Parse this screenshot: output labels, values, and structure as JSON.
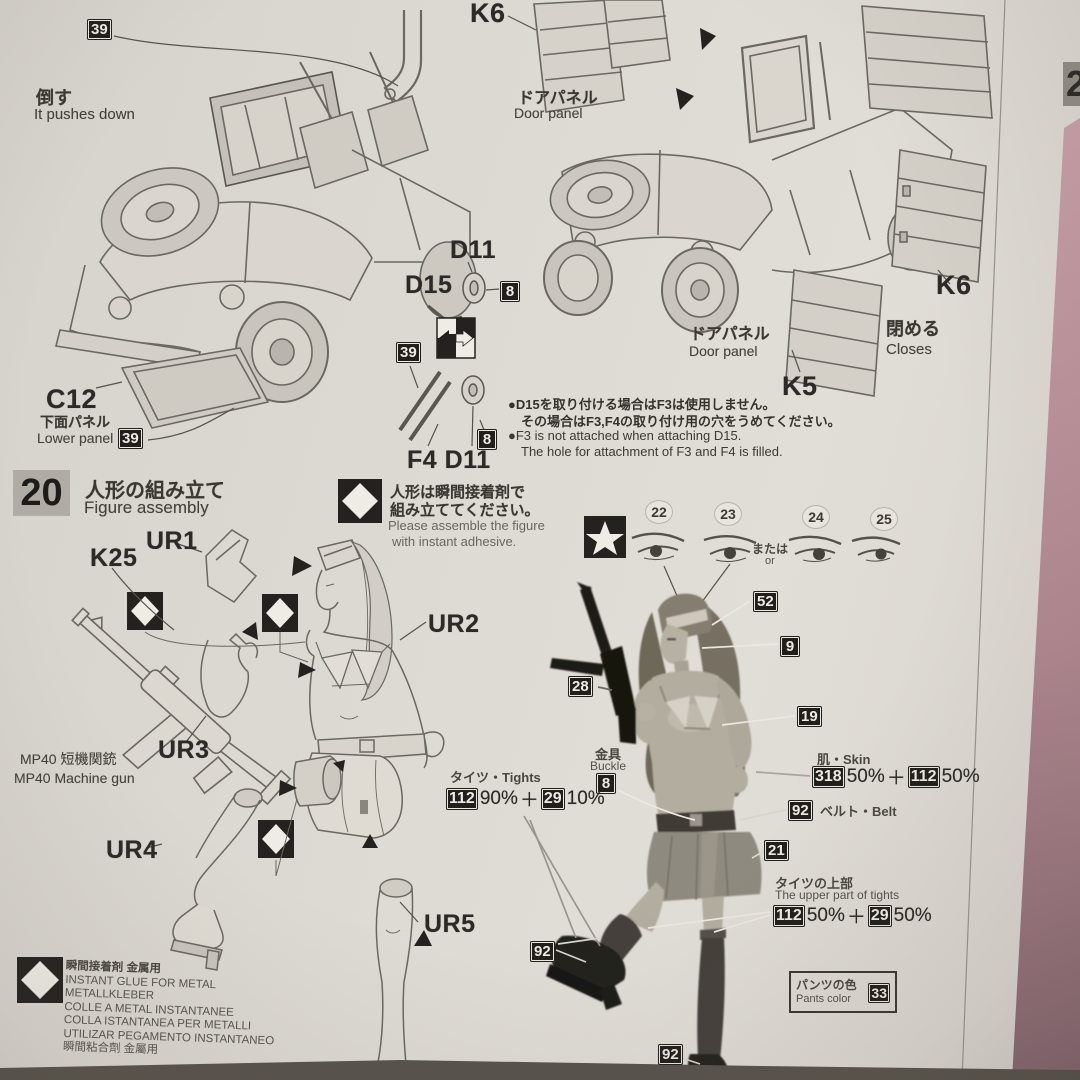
{
  "s19": {
    "b39a": "39",
    "push_jp": "倒す",
    "push_en": "It pushes down",
    "c12": "C12",
    "lower_jp": "下面パネル",
    "lower_en": "Lower panel",
    "b39b": "39",
    "d11": "D11",
    "d15": "D15",
    "b8a": "8",
    "b39c": "39",
    "f4d11": "F4 D11",
    "b8b": "8",
    "k6a": "K6",
    "dp1jp": "ドアパネル",
    "dp1en": "Door panel",
    "k6b": "K6",
    "k5": "K5",
    "dp2jp": "ドアパネル",
    "dp2en": "Door panel",
    "closejp": "閉める",
    "closeen": "Closes",
    "n1": "●D15を取り付ける場合はF3は使用しません。",
    "n2": "その場合はF3,F4の取り付け用の穴をうめてください。",
    "n3": "●F3 is not attached when attaching D15.",
    "n4": "The hole for attachment of F3 and F4 is filled."
  },
  "s20": {
    "num": "20",
    "tjp": "人形の組み立て",
    "ten": "Figure assembly",
    "ajp1": "人形は瞬間接着剤で",
    "ajp2": "組み立ててください。",
    "aen1": "Please assemble the figure",
    "aen2": "with instant adhesive.",
    "e22": "22",
    "e23": "23",
    "e24": "24",
    "e25": "25",
    "orjp": "または",
    "oren": "or",
    "k25": "K25",
    "ur1": "UR1",
    "ur2": "UR2",
    "ur3": "UR3",
    "ur4": "UR4",
    "ur5": "UR5",
    "mpjp": "MP40 短機関銃",
    "mpen": "MP40 Machine gun",
    "b52": "52",
    "b9": "9",
    "b28": "28",
    "b19": "19",
    "bucklejp": "金具",
    "buckleen": "Buckle",
    "b8": "8",
    "skin": "肌・Skin",
    "sc1": "318",
    "sp1": "50%",
    "plus": "＋",
    "sc2": "112",
    "sp2": "50%",
    "b92a": "92",
    "belt": "ベルト・Belt",
    "tights": "タイツ・Tights",
    "tc1": "112",
    "tp1": "90%",
    "tc2": "29",
    "tp2": "10%",
    "b21": "21",
    "tujp": "タイツの上部",
    "tuen": "The upper part of tights",
    "tuc1": "112",
    "tup1": "50%",
    "tuc2": "29",
    "tup2": "50%",
    "b92b": "92",
    "b92c": "92",
    "pantsjp": "パンツの色",
    "pantsen": "Pants color",
    "b33": "33"
  },
  "glue": {
    "l1": "瞬間接着剤 金属用",
    "l2": "INSTANT GLUE FOR METAL",
    "l3": "METALLKLEBER",
    "l4": "COLLE A METAL INSTANTANEE",
    "l5": "COLLA ISTANTANEA PER METALLI",
    "l6": "UTILIZAR PEGAMENTO INSTANTANEO",
    "l7": "瞬間粘合劑 金屬用"
  },
  "edge": {
    "p2": "2"
  }
}
